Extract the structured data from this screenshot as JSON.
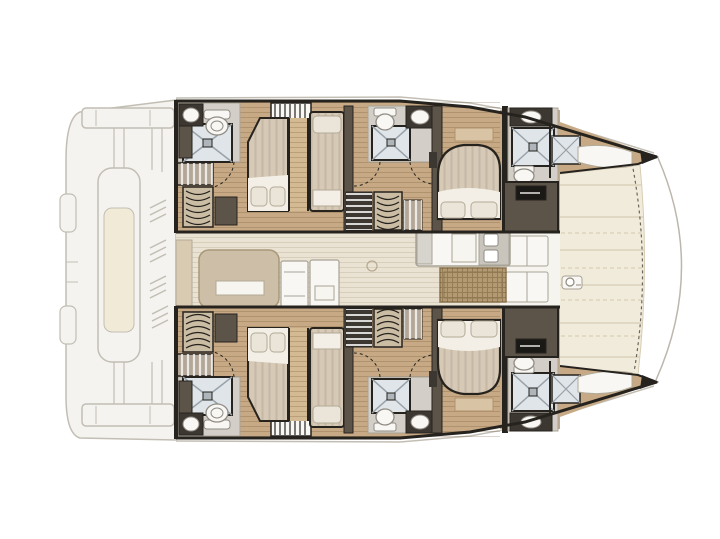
{
  "description": "Top-view interior layout plan of a sailing catamaran: faded aft cockpit at left, central saloon with galley, four en-suite guest cabins in the two hulls, forward cockpit deck between the two bow tips at right. No text labels are rendered in the drawing.",
  "colors": {
    "paper": "#ffffff",
    "ink": "#26231e",
    "faded": "#f4f2ee",
    "fadedLine": "#bcb7ac",
    "cushion": "#f0e8d2",
    "deck": "#f1ebdb",
    "deckLine": "#d7cdb5",
    "walkway": "#f6f4ef",
    "saloon": "#eae3d3",
    "wood": "#c7aa85",
    "woodLine": "#b2926c",
    "walkWood": "#d4ba93",
    "wallDark": "#4d463e",
    "wallBrown": "#5c5349",
    "cabinetDark": "#3c3731",
    "taupe": "#b3a897",
    "locker": "#cbbca4",
    "bedTan": "#d6c9b6",
    "sheet": "#f3efe6",
    "pillow": "#eae5d8",
    "pillowLine": "#b3aa97",
    "showerFloor": "#dfe5e9",
    "showerLine": "#99a1a9",
    "fixtureWhite": "#f8f7f4",
    "fixtureLine": "#908c84",
    "mat": "#b49a72",
    "matLine": "#8d7550",
    "headFloor": "#d3cfc8",
    "black": "#1b1916",
    "cabLine": "#a8a396",
    "sofaTan": "#cdbfa7",
    "tanStrip": "#d9cbb2",
    "tableWhite": "#f7f5ef"
  },
  "regions": [
    "aft-cockpit-faded",
    "port-hull-cabins",
    "starboard-hull-cabins",
    "saloon",
    "galley-island",
    "forward-cockpit-deck",
    "bow-tips"
  ],
  "visible_fixtures": {
    "double_beds": 4,
    "single_berths": 2,
    "bow_berths": 2,
    "shower_trays": 8,
    "toilets": 6,
    "sinks": 6,
    "hanging_lockers": 4,
    "companionway_ladders": 2,
    "saloon_sofas": 1,
    "galley_islands": 1,
    "woven_floor_mats": 1
  }
}
